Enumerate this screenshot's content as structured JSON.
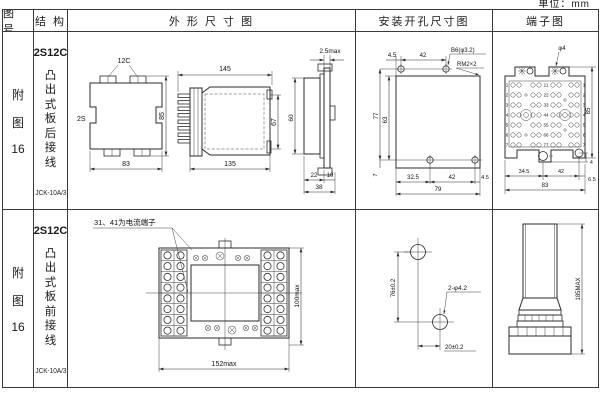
{
  "page": {
    "unit_note": "单位：mm"
  },
  "headers": {
    "fig_no": "图 号",
    "structure": "结 构",
    "outline": "外 形 尺 寸 图",
    "mounting": "安装开孔尺寸图",
    "terminal": "端子图"
  },
  "rows": [
    {
      "fig_no": [
        "附",
        "图",
        "16"
      ],
      "model": "2S12C",
      "mount_style": [
        "凸",
        "出",
        "式",
        "板",
        "后",
        "接",
        "线"
      ],
      "relay_type": "JCK-10A/3",
      "outline": {
        "front": {
          "label_top": "12C",
          "label_left": "2S",
          "dim_height": "85",
          "dim_width": "83"
        },
        "side": {
          "dim_top": "145",
          "dim_bottom": "135",
          "dim_height": "67"
        },
        "profile": {
          "dim_flange": "2.5max",
          "dim_height": "60",
          "dim_b1": "22",
          "dim_b2": "10",
          "dim_b3": "38"
        }
      },
      "mounting": {
        "dim_t1": "4.5",
        "dim_t2": "42",
        "hole_spec": "B6(φ3.2)",
        "thread_spec": "RM2×2",
        "dim_l1": "77",
        "dim_l2": "63",
        "dim_l3": "7",
        "dim_b1": "32.5",
        "dim_b2": "42",
        "dim_b3": "4.5",
        "dim_total": "79"
      },
      "terminal": {
        "callout": "φ4",
        "dim_height": "85",
        "dim_small": "4",
        "dim_b1": "34.5",
        "dim_b2": "42",
        "dim_b3": "6.5",
        "dim_total": "83",
        "row_numbers": [
          "1",
          "2",
          "3",
          "4",
          "5",
          "6",
          "7"
        ],
        "center_numbers": [
          "11",
          "22",
          "33",
          "44",
          "55",
          "66",
          "77"
        ]
      }
    },
    {
      "fig_no": [
        "附",
        "图",
        "16"
      ],
      "model": "2S12C",
      "mount_style": [
        "凸",
        "出",
        "式",
        "板",
        "前",
        "接",
        "线"
      ],
      "relay_type": "JCK-10A/3",
      "outline": {
        "callout": "31、41为电流端子",
        "dim_width": "152max",
        "dim_height": "100max"
      },
      "mounting": {
        "dim_v": "76±0.2",
        "dim_h": "20±0.2",
        "hole_spec": "2-φ4.2"
      },
      "terminal": {
        "dim_height": "185MAX"
      }
    }
  ]
}
